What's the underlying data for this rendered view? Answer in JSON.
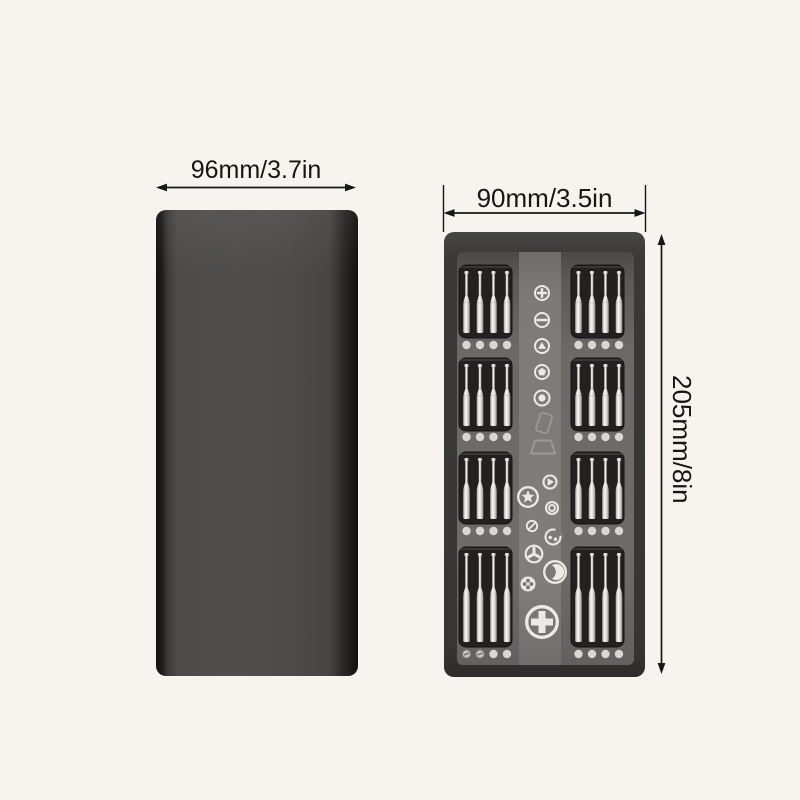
{
  "page": {
    "background_color": "#f7f4ef",
    "text_color": "#171615"
  },
  "diagram": {
    "closed_case": {
      "width_label": "96mm/3.7in",
      "body_color": "#4e4b49",
      "edge_color": "#141312"
    },
    "open_case": {
      "width_label": "90mm/3.5in",
      "height_label": "205mm/8in",
      "frame_color": "#3a3937",
      "tray_color": "#6b6967",
      "strip_color": "#7c7a77",
      "slot_color": "#222120",
      "bit_color": "#efeeec",
      "dot_color": "#d9d7d3",
      "icon_color": "#eceae7",
      "layout": {
        "svg_width": 201,
        "svg_height": 445,
        "tray": {
          "x": 13,
          "y": 20,
          "w": 177,
          "h": 413
        },
        "strip": {
          "x": 75,
          "y": 20,
          "w": 42,
          "h": 413
        },
        "slot_rows": [
          {
            "y": 33,
            "h": 73,
            "dots_cy": 113
          },
          {
            "y": 126,
            "h": 73,
            "dots_cy": 205
          },
          {
            "y": 220,
            "h": 72,
            "dots_cy": 299
          },
          {
            "y": 315,
            "h": 100,
            "dots_cy": 422
          }
        ],
        "slot_columns": [
          {
            "x": 15
          },
          {
            "x": 127
          }
        ],
        "slot_width": 53,
        "bits_per_slot": 4,
        "bit_offsets": [
          7.5,
          21,
          34.5,
          48
        ],
        "screw_dots_row": 3,
        "screw_dots_col": 0,
        "screw_dots_count": 2
      },
      "head_icons": [
        {
          "name": "phillips-small-icon",
          "type": "phillips",
          "cx": 98,
          "cy": 61,
          "r": 8
        },
        {
          "name": "slotted-icon",
          "type": "slotted",
          "cx": 98,
          "cy": 88,
          "r": 8
        },
        {
          "name": "triangle-icon",
          "type": "triangle",
          "cx": 98,
          "cy": 114,
          "r": 8
        },
        {
          "name": "pentalobe-icon",
          "type": "pentalobe",
          "cx": 98,
          "cy": 140,
          "r": 8
        },
        {
          "name": "dot-ring-icon",
          "type": "dotring",
          "cx": 98,
          "cy": 166,
          "r": 8.5
        },
        {
          "name": "phone-outline-icon",
          "type": "phone",
          "cx": 100,
          "cy": 191,
          "r": 10,
          "faint": true
        },
        {
          "name": "laptop-outline-icon",
          "type": "laptop",
          "cx": 98,
          "cy": 215,
          "r": 12,
          "faint": true
        },
        {
          "name": "play-icon",
          "type": "play",
          "cx": 106,
          "cy": 250,
          "r": 7.5
        },
        {
          "name": "torx-star-icon",
          "type": "torx",
          "cx": 84,
          "cy": 265,
          "r": 11
        },
        {
          "name": "double-ring-icon",
          "type": "doublering",
          "cx": 108,
          "cy": 276,
          "r": 7
        },
        {
          "name": "slash-icon",
          "type": "slash",
          "cx": 88,
          "cy": 294,
          "r": 6
        },
        {
          "name": "spanner-icon",
          "type": "spanner",
          "cx": 109,
          "cy": 305,
          "r": 8.5
        },
        {
          "name": "tri-wing-icon",
          "type": "triwing",
          "cx": 90,
          "cy": 322,
          "r": 9.5
        },
        {
          "name": "crescent-icon",
          "type": "crescent",
          "cx": 111,
          "cy": 340,
          "r": 12
        },
        {
          "name": "clover-icon",
          "type": "clover",
          "cx": 84,
          "cy": 352,
          "r": 7.5
        },
        {
          "name": "phillips-large-icon",
          "type": "phillips-large",
          "cx": 98,
          "cy": 390,
          "r": 17
        }
      ]
    }
  }
}
